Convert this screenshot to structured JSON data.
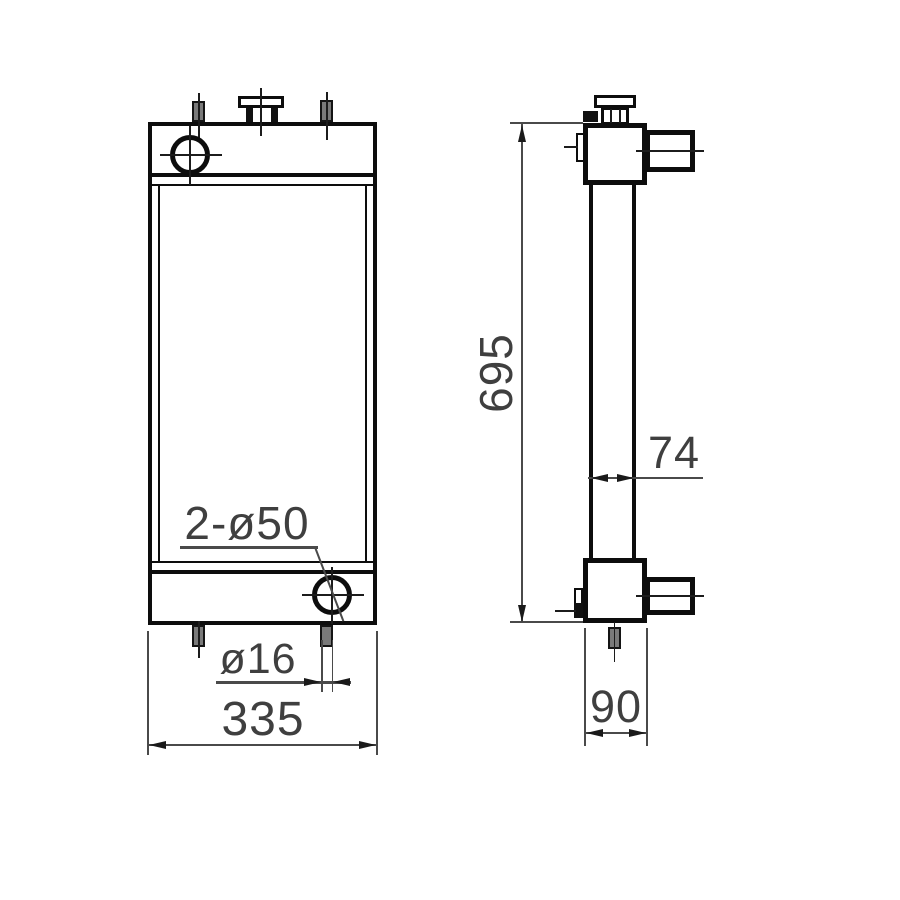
{
  "drawing_title": "Radiator two-view engineering drawing",
  "colors": {
    "object_line": "#0d0d0d",
    "dimension_text": "#3f3f3f",
    "pin_fill": "#7a7a7a",
    "background": "#ffffff"
  },
  "views": {
    "front": {
      "labels": {
        "holes_callout": "2-ø50",
        "pin_diameter": "ø16",
        "overall_width": "335"
      }
    },
    "side": {
      "labels": {
        "overall_height": "695",
        "core_thickness": "74",
        "tank_depth": "90"
      }
    }
  }
}
